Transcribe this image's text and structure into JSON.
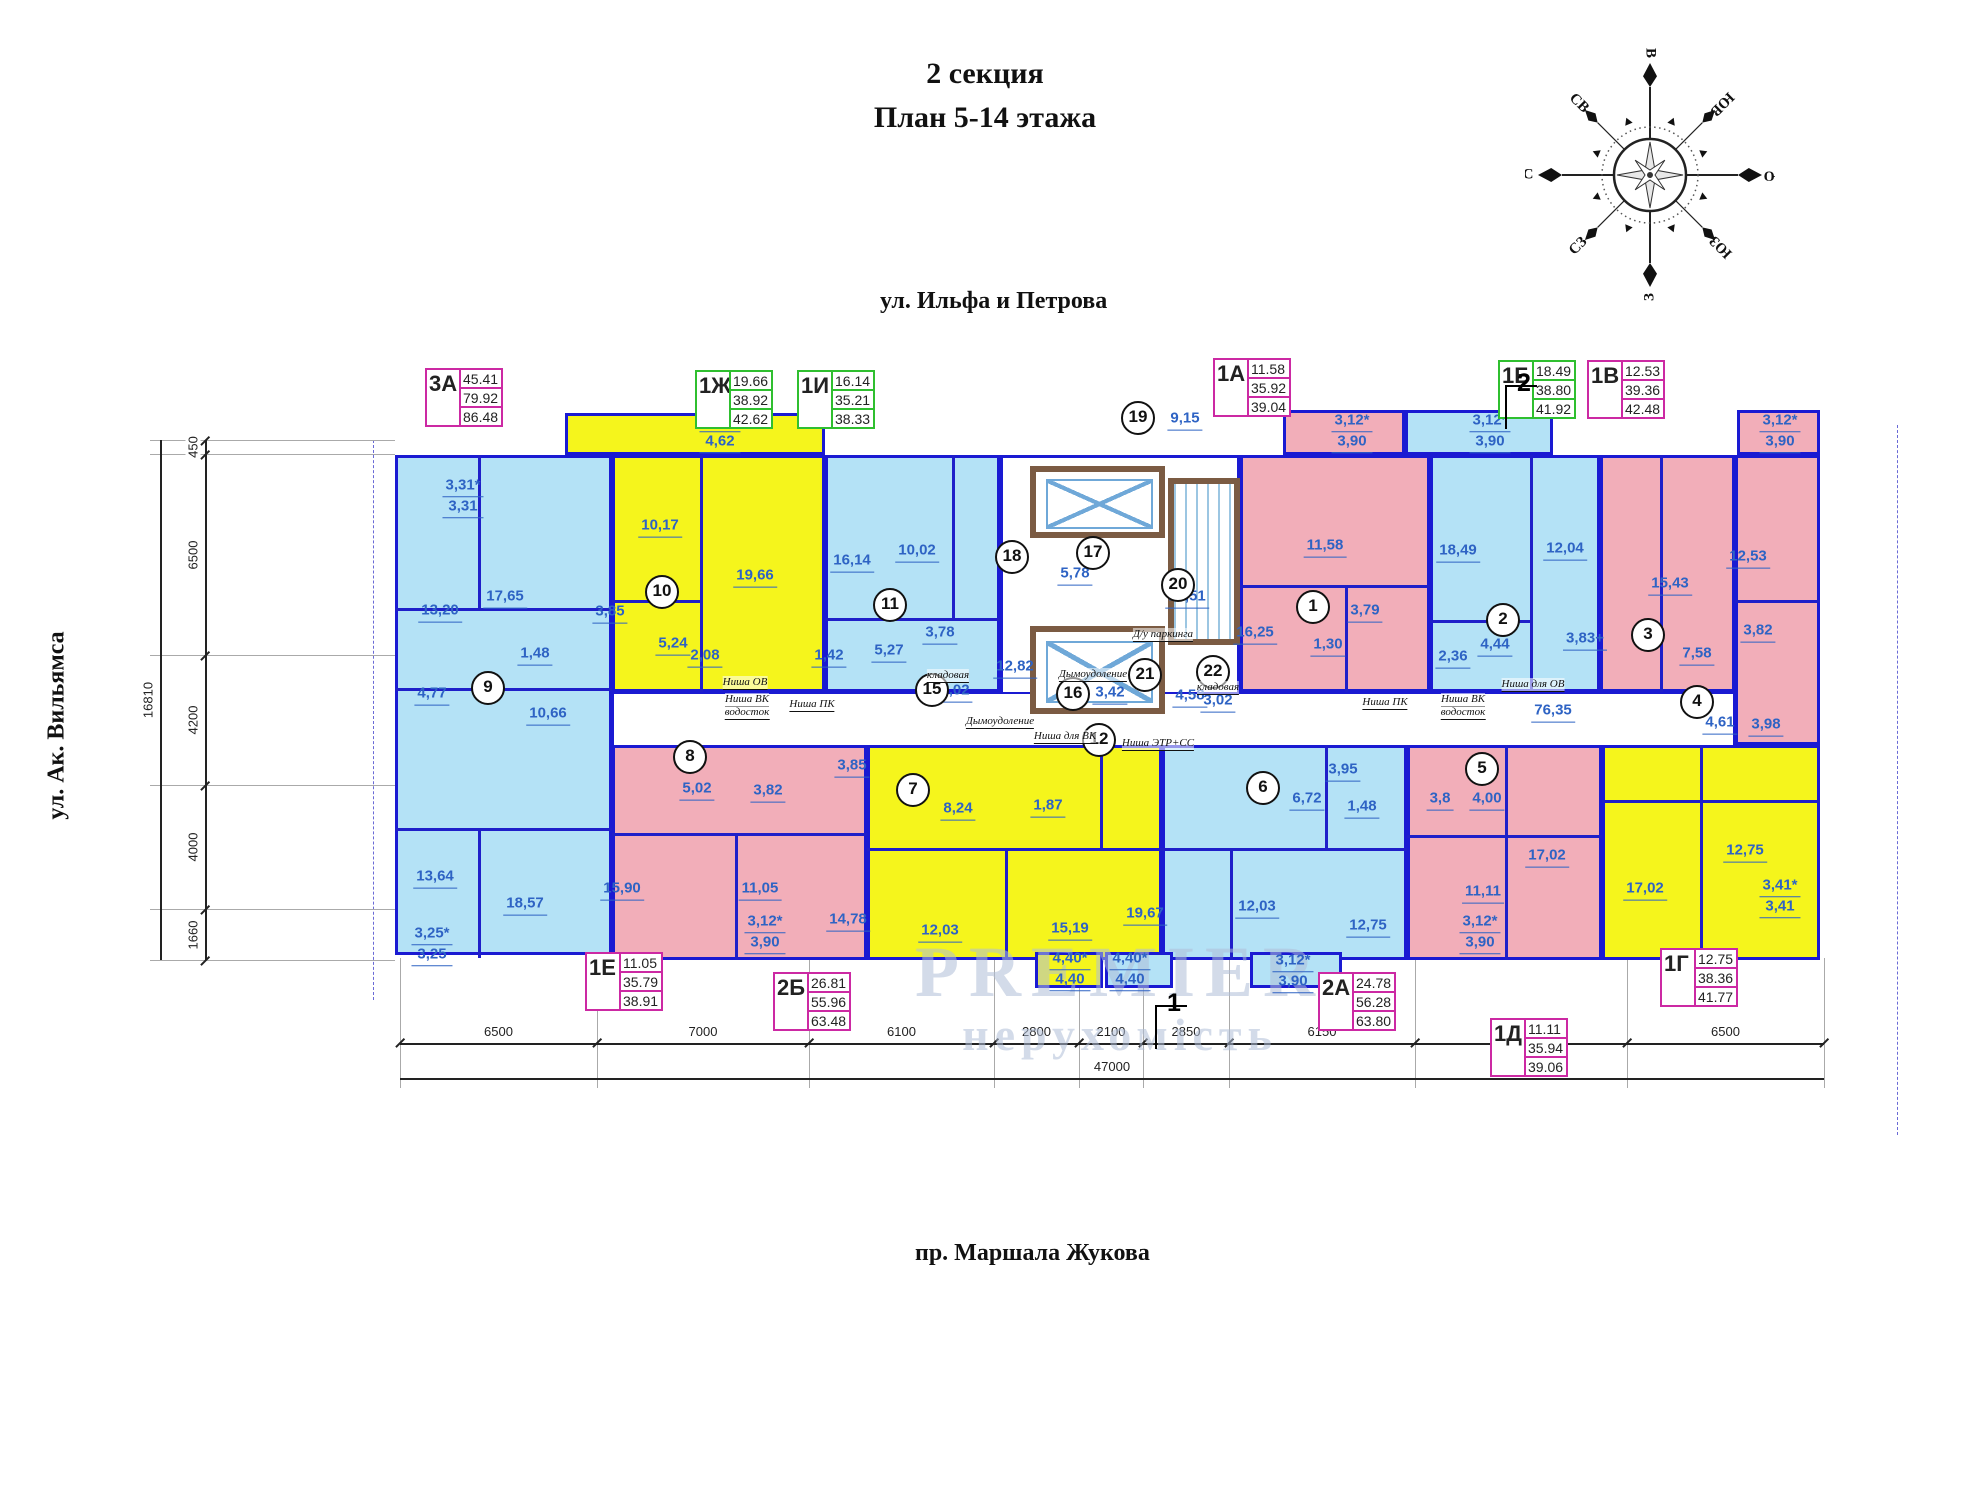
{
  "title": {
    "line1": "2 секция",
    "line2": "План 5-14 этажа"
  },
  "streets": {
    "top": "ул. Ильфа и Петрова",
    "left": "ул. Ак. Вильямса",
    "bottom": "пр. Маршала Жукова"
  },
  "watermark": {
    "line1": "PREMIER",
    "line2": "нерухомість"
  },
  "compass": {
    "labels": [
      "В",
      "ЮВ",
      "Ю",
      "ЮЗ",
      "З",
      "СЗ",
      "С",
      "СВ"
    ]
  },
  "colors": {
    "wall": "#1a1ad2",
    "room_blue": "#b4e2f6",
    "room_pink": "#f2aeb9",
    "room_yellow": "#f5f51c",
    "table_magenta": "#cc29a3",
    "table_green": "#2fbf2f",
    "area_label": "#2e63c4",
    "core_wall": "#7b5b43"
  },
  "apt_tables": [
    {
      "id": "3А",
      "color": "magenta",
      "x": 425,
      "y": 368,
      "values": [
        "45.41",
        "79.92",
        "86.48"
      ]
    },
    {
      "id": "1Ж",
      "color": "green",
      "x": 695,
      "y": 370,
      "values": [
        "19.66",
        "38.92",
        "42.62"
      ]
    },
    {
      "id": "1И",
      "color": "green",
      "x": 797,
      "y": 370,
      "values": [
        "16.14",
        "35.21",
        "38.33"
      ]
    },
    {
      "id": "1А",
      "color": "magenta",
      "x": 1213,
      "y": 358,
      "values": [
        "11.58",
        "35.92",
        "39.04"
      ]
    },
    {
      "id": "1Б",
      "color": "green",
      "x": 1498,
      "y": 360,
      "values": [
        "18.49",
        "38.80",
        "41.92"
      ]
    },
    {
      "id": "1В",
      "color": "magenta",
      "x": 1587,
      "y": 360,
      "values": [
        "12.53",
        "39.36",
        "42.48"
      ]
    },
    {
      "id": "1Е",
      "color": "magenta",
      "x": 585,
      "y": 952,
      "values": [
        "11.05",
        "35.79",
        "38.91"
      ]
    },
    {
      "id": "2Б",
      "color": "magenta",
      "x": 773,
      "y": 972,
      "values": [
        "26.81",
        "55.96",
        "63.48"
      ]
    },
    {
      "id": "2А",
      "color": "magenta",
      "x": 1318,
      "y": 972,
      "values": [
        "24.78",
        "56.28",
        "63.80"
      ]
    },
    {
      "id": "1Д",
      "color": "magenta",
      "x": 1490,
      "y": 1018,
      "values": [
        "11.11",
        "35.94",
        "39.06"
      ]
    },
    {
      "id": "1Г",
      "color": "magenta",
      "x": 1660,
      "y": 948,
      "values": [
        "12.75",
        "38.36",
        "41.77"
      ]
    }
  ],
  "section_markers": [
    {
      "label": "2",
      "x": 1505,
      "y": 385
    },
    {
      "label": "1",
      "x": 1155,
      "y": 1005
    }
  ],
  "blocks": [
    {
      "x": 565,
      "y": 413,
      "w": 260,
      "h": 42,
      "f": "yellow"
    },
    {
      "x": 1283,
      "y": 410,
      "w": 122,
      "h": 45,
      "f": "pink"
    },
    {
      "x": 1405,
      "y": 410,
      "w": 148,
      "h": 45,
      "f": "blue"
    },
    {
      "x": 1737,
      "y": 410,
      "w": 83,
      "h": 45,
      "f": "pink"
    },
    {
      "x": 395,
      "y": 455,
      "w": 217,
      "h": 500,
      "f": "blue"
    },
    {
      "x": 612,
      "y": 455,
      "w": 213,
      "h": 237,
      "f": "yellow"
    },
    {
      "x": 825,
      "y": 455,
      "w": 175,
      "h": 237,
      "f": "blue"
    },
    {
      "x": 1000,
      "y": 455,
      "w": 240,
      "h": 285,
      "f": "white"
    },
    {
      "x": 1240,
      "y": 455,
      "w": 190,
      "h": 237,
      "f": "pink"
    },
    {
      "x": 1430,
      "y": 455,
      "w": 170,
      "h": 237,
      "f": "blue"
    },
    {
      "x": 1600,
      "y": 455,
      "w": 135,
      "h": 237,
      "f": "pink"
    },
    {
      "x": 1735,
      "y": 455,
      "w": 85,
      "h": 290,
      "f": "pink"
    },
    {
      "x": 612,
      "y": 692,
      "w": 1123,
      "h": 55,
      "f": "corr"
    },
    {
      "x": 612,
      "y": 745,
      "w": 255,
      "h": 215,
      "f": "pink"
    },
    {
      "x": 867,
      "y": 745,
      "w": 295,
      "h": 215,
      "f": "yellow"
    },
    {
      "x": 1162,
      "y": 745,
      "w": 245,
      "h": 215,
      "f": "blue"
    },
    {
      "x": 1407,
      "y": 745,
      "w": 195,
      "h": 215,
      "f": "pink"
    },
    {
      "x": 1602,
      "y": 745,
      "w": 218,
      "h": 215,
      "f": "yellow"
    },
    {
      "x": 1035,
      "y": 952,
      "w": 68,
      "h": 36,
      "f": "yellow"
    },
    {
      "x": 1105,
      "y": 952,
      "w": 68,
      "h": 36,
      "f": "blue"
    },
    {
      "x": 1250,
      "y": 952,
      "w": 92,
      "h": 36,
      "f": "blue"
    },
    {
      "x": 1030,
      "y": 466,
      "w": 135,
      "h": 72,
      "f": "elev"
    },
    {
      "x": 1030,
      "y": 626,
      "w": 135,
      "h": 88,
      "f": "elev"
    },
    {
      "x": 1168,
      "y": 478,
      "w": 72,
      "h": 167,
      "f": "stairs"
    }
  ],
  "walls": [
    {
      "x": 395,
      "y": 608,
      "w": 217,
      "h": 3
    },
    {
      "x": 478,
      "y": 455,
      "w": 3,
      "h": 153
    },
    {
      "x": 395,
      "y": 688,
      "w": 217,
      "h": 3
    },
    {
      "x": 395,
      "y": 828,
      "w": 217,
      "h": 3
    },
    {
      "x": 478,
      "y": 828,
      "w": 3,
      "h": 130
    },
    {
      "x": 700,
      "y": 455,
      "w": 3,
      "h": 237
    },
    {
      "x": 612,
      "y": 600,
      "w": 90,
      "h": 3
    },
    {
      "x": 952,
      "y": 455,
      "w": 3,
      "h": 165
    },
    {
      "x": 825,
      "y": 618,
      "w": 175,
      "h": 3
    },
    {
      "x": 1240,
      "y": 585,
      "w": 190,
      "h": 3
    },
    {
      "x": 1345,
      "y": 585,
      "w": 3,
      "h": 107
    },
    {
      "x": 1530,
      "y": 455,
      "w": 3,
      "h": 237
    },
    {
      "x": 1430,
      "y": 620,
      "w": 100,
      "h": 3
    },
    {
      "x": 1660,
      "y": 455,
      "w": 3,
      "h": 237
    },
    {
      "x": 1735,
      "y": 600,
      "w": 85,
      "h": 3
    },
    {
      "x": 612,
      "y": 833,
      "w": 255,
      "h": 3
    },
    {
      "x": 735,
      "y": 833,
      "w": 3,
      "h": 127
    },
    {
      "x": 867,
      "y": 848,
      "w": 295,
      "h": 3
    },
    {
      "x": 1005,
      "y": 848,
      "w": 3,
      "h": 112
    },
    {
      "x": 1100,
      "y": 745,
      "w": 3,
      "h": 103
    },
    {
      "x": 1162,
      "y": 848,
      "w": 245,
      "h": 3
    },
    {
      "x": 1230,
      "y": 848,
      "w": 3,
      "h": 112
    },
    {
      "x": 1325,
      "y": 745,
      "w": 3,
      "h": 103
    },
    {
      "x": 1407,
      "y": 835,
      "w": 195,
      "h": 3
    },
    {
      "x": 1505,
      "y": 745,
      "w": 3,
      "h": 215
    },
    {
      "x": 1700,
      "y": 745,
      "w": 3,
      "h": 215
    },
    {
      "x": 1602,
      "y": 800,
      "w": 218,
      "h": 3
    }
  ],
  "room_labels": [
    {
      "x": 463,
      "y": 497,
      "t1": "3,31*",
      "t2": "3,31"
    },
    {
      "x": 440,
      "y": 612,
      "t1": "13,20"
    },
    {
      "x": 505,
      "y": 598,
      "t1": "17,65"
    },
    {
      "x": 432,
      "y": 695,
      "t1": "4,77"
    },
    {
      "x": 548,
      "y": 715,
      "t1": "10,66"
    },
    {
      "x": 535,
      "y": 655,
      "t1": "1,48"
    },
    {
      "x": 435,
      "y": 878,
      "t1": "13,64"
    },
    {
      "x": 525,
      "y": 905,
      "t1": "18,57"
    },
    {
      "x": 432,
      "y": 945,
      "t1": "3,25*",
      "t2": "3,25"
    },
    {
      "x": 720,
      "y": 432,
      "t1": "3,70*",
      "t2": "4,62"
    },
    {
      "x": 660,
      "y": 527,
      "t1": "10,17"
    },
    {
      "x": 755,
      "y": 577,
      "t1": "19,66"
    },
    {
      "x": 610,
      "y": 613,
      "t1": "3,85"
    },
    {
      "x": 673,
      "y": 645,
      "t1": "5,24"
    },
    {
      "x": 705,
      "y": 657,
      "t1": "2,08"
    },
    {
      "x": 852,
      "y": 562,
      "t1": "16,14"
    },
    {
      "x": 917,
      "y": 552,
      "t1": "10,02"
    },
    {
      "x": 940,
      "y": 634,
      "t1": "3,78"
    },
    {
      "x": 889,
      "y": 652,
      "t1": "5,27"
    },
    {
      "x": 829,
      "y": 657,
      "t1": "1,42"
    },
    {
      "x": 955,
      "y": 692,
      "t1": "2,02"
    },
    {
      "x": 1015,
      "y": 668,
      "t1": "12,82"
    },
    {
      "x": 1075,
      "y": 575,
      "t1": "5,78"
    },
    {
      "x": 1187,
      "y": 598,
      "t1": "14,51"
    },
    {
      "x": 1185,
      "y": 420,
      "t1": "9,15"
    },
    {
      "x": 1110,
      "y": 694,
      "t1": "3,42"
    },
    {
      "x": 1190,
      "y": 697,
      "t1": "4,58"
    },
    {
      "x": 1218,
      "y": 702,
      "t1": "3,02"
    },
    {
      "x": 1325,
      "y": 547,
      "t1": "11,58"
    },
    {
      "x": 1255,
      "y": 634,
      "t1": "16,25"
    },
    {
      "x": 1365,
      "y": 612,
      "t1": "3,79"
    },
    {
      "x": 1328,
      "y": 646,
      "t1": "1,30"
    },
    {
      "x": 1352,
      "y": 432,
      "t1": "3,12*",
      "t2": "3,90"
    },
    {
      "x": 1490,
      "y": 432,
      "t1": "3,12*",
      "t2": "3,90"
    },
    {
      "x": 1780,
      "y": 432,
      "t1": "3,12*",
      "t2": "3,90"
    },
    {
      "x": 1458,
      "y": 552,
      "t1": "18,49"
    },
    {
      "x": 1565,
      "y": 550,
      "t1": "12,04"
    },
    {
      "x": 1453,
      "y": 658,
      "t1": "2,36"
    },
    {
      "x": 1495,
      "y": 646,
      "t1": "4,44"
    },
    {
      "x": 1585,
      "y": 640,
      "t1": "3,83+"
    },
    {
      "x": 1670,
      "y": 585,
      "t1": "15,43"
    },
    {
      "x": 1697,
      "y": 655,
      "t1": "7,58"
    },
    {
      "x": 1748,
      "y": 558,
      "t1": "12,53"
    },
    {
      "x": 1758,
      "y": 632,
      "t1": "3,82"
    },
    {
      "x": 1720,
      "y": 724,
      "t1": "4,61"
    },
    {
      "x": 1766,
      "y": 726,
      "t1": "3,98"
    },
    {
      "x": 1553,
      "y": 712,
      "t1": "76,35"
    },
    {
      "x": 697,
      "y": 790,
      "t1": "5,02"
    },
    {
      "x": 768,
      "y": 792,
      "t1": "3,82"
    },
    {
      "x": 622,
      "y": 890,
      "t1": "15,90"
    },
    {
      "x": 760,
      "y": 890,
      "t1": "11,05"
    },
    {
      "x": 765,
      "y": 933,
      "t1": "3,12*",
      "t2": "3,90"
    },
    {
      "x": 852,
      "y": 767,
      "t1": "3,85"
    },
    {
      "x": 958,
      "y": 810,
      "t1": "8,24"
    },
    {
      "x": 1048,
      "y": 807,
      "t1": "1,87"
    },
    {
      "x": 848,
      "y": 921,
      "t1": "14,78"
    },
    {
      "x": 940,
      "y": 932,
      "t1": "12,03"
    },
    {
      "x": 1070,
      "y": 930,
      "t1": "15,19"
    },
    {
      "x": 1307,
      "y": 800,
      "t1": "6,72"
    },
    {
      "x": 1343,
      "y": 771,
      "t1": "3,95"
    },
    {
      "x": 1362,
      "y": 808,
      "t1": "1,48"
    },
    {
      "x": 1145,
      "y": 915,
      "t1": "19,67"
    },
    {
      "x": 1257,
      "y": 908,
      "t1": "12,03"
    },
    {
      "x": 1368,
      "y": 927,
      "t1": "12,75"
    },
    {
      "x": 1070,
      "y": 970,
      "t1": "4,40*",
      "t2": "4,40"
    },
    {
      "x": 1130,
      "y": 970,
      "t1": "4,40*",
      "t2": "4,40"
    },
    {
      "x": 1293,
      "y": 972,
      "t1": "3,12*",
      "t2": "3,90"
    },
    {
      "x": 1440,
      "y": 800,
      "t1": "3,8"
    },
    {
      "x": 1487,
      "y": 800,
      "t1": "4,00"
    },
    {
      "x": 1483,
      "y": 893,
      "t1": "11,11"
    },
    {
      "x": 1480,
      "y": 933,
      "t1": "3,12*",
      "t2": "3,90"
    },
    {
      "x": 1547,
      "y": 857,
      "t1": "17,02"
    },
    {
      "x": 1645,
      "y": 890,
      "t1": "17,02"
    },
    {
      "x": 1745,
      "y": 852,
      "t1": "12,75"
    },
    {
      "x": 1780,
      "y": 897,
      "t1": "3,41*",
      "t2": "3,41"
    }
  ],
  "circles": [
    {
      "n": "1",
      "x": 1313,
      "y": 607
    },
    {
      "n": "2",
      "x": 1503,
      "y": 620
    },
    {
      "n": "3",
      "x": 1648,
      "y": 635
    },
    {
      "n": "4",
      "x": 1697,
      "y": 702
    },
    {
      "n": "5",
      "x": 1482,
      "y": 769
    },
    {
      "n": "6",
      "x": 1263,
      "y": 788
    },
    {
      "n": "7",
      "x": 913,
      "y": 790
    },
    {
      "n": "8",
      "x": 690,
      "y": 757
    },
    {
      "n": "9",
      "x": 488,
      "y": 688
    },
    {
      "n": "10",
      "x": 662,
      "y": 592
    },
    {
      "n": "11",
      "x": 890,
      "y": 605
    },
    {
      "n": "12",
      "x": 1099,
      "y": 740
    },
    {
      "n": "15",
      "x": 932,
      "y": 690
    },
    {
      "n": "16",
      "x": 1073,
      "y": 694
    },
    {
      "n": "17",
      "x": 1093,
      "y": 553
    },
    {
      "n": "18",
      "x": 1012,
      "y": 557
    },
    {
      "n": "19",
      "x": 1138,
      "y": 418
    },
    {
      "n": "20",
      "x": 1178,
      "y": 585
    },
    {
      "n": "21",
      "x": 1145,
      "y": 675
    },
    {
      "n": "22",
      "x": 1213,
      "y": 672
    }
  ],
  "notes": [
    {
      "x": 745,
      "y": 683,
      "t": "Ниша ОВ"
    },
    {
      "x": 747,
      "y": 700,
      "t": "Ниша ВК"
    },
    {
      "x": 747,
      "y": 713,
      "t": "водосток"
    },
    {
      "x": 812,
      "y": 705,
      "t": "Ниша ПК"
    },
    {
      "x": 1385,
      "y": 703,
      "t": "Ниша ПК"
    },
    {
      "x": 1463,
      "y": 700,
      "t": "Ниша ВК"
    },
    {
      "x": 1463,
      "y": 713,
      "t": "водосток"
    },
    {
      "x": 1533,
      "y": 685,
      "t": "Ниша для ОВ"
    },
    {
      "x": 1065,
      "y": 737,
      "t": "Ниша для ВК"
    },
    {
      "x": 1158,
      "y": 744,
      "t": "Ниша ЭТР+СС"
    },
    {
      "x": 1093,
      "y": 675,
      "t": "Дымоудоление"
    },
    {
      "x": 1000,
      "y": 722,
      "t": "Дымоудоление"
    },
    {
      "x": 948,
      "y": 676,
      "t": "кладовая"
    },
    {
      "x": 1218,
      "y": 688,
      "t": "кладовая"
    },
    {
      "x": 1163,
      "y": 635,
      "t": "Д/у паркинга"
    }
  ],
  "dims_bottom": {
    "y": 1043,
    "x_start": 400,
    "segments": [
      {
        "label": "6500",
        "w": 197
      },
      {
        "label": "7000",
        "w": 212
      },
      {
        "label": "6100",
        "w": 185
      },
      {
        "label": "2800",
        "w": 85
      },
      {
        "label": "2100",
        "w": 64
      },
      {
        "label": "2850",
        "w": 86
      },
      {
        "label": "6150",
        "w": 186
      },
      {
        "label": "7000",
        "w": 212
      },
      {
        "label": "6500",
        "w": 197
      }
    ],
    "total": {
      "label": "47000",
      "y": 1078
    }
  },
  "dims_left": {
    "x": 205,
    "y_start": 440,
    "segments": [
      {
        "label": "450",
        "h": 14
      },
      {
        "label": "6500",
        "h": 201
      },
      {
        "label": "4200",
        "h": 130
      },
      {
        "label": "4000",
        "h": 124
      },
      {
        "label": "1660",
        "h": 51
      }
    ],
    "total": {
      "label": "16810",
      "x": 160
    }
  }
}
